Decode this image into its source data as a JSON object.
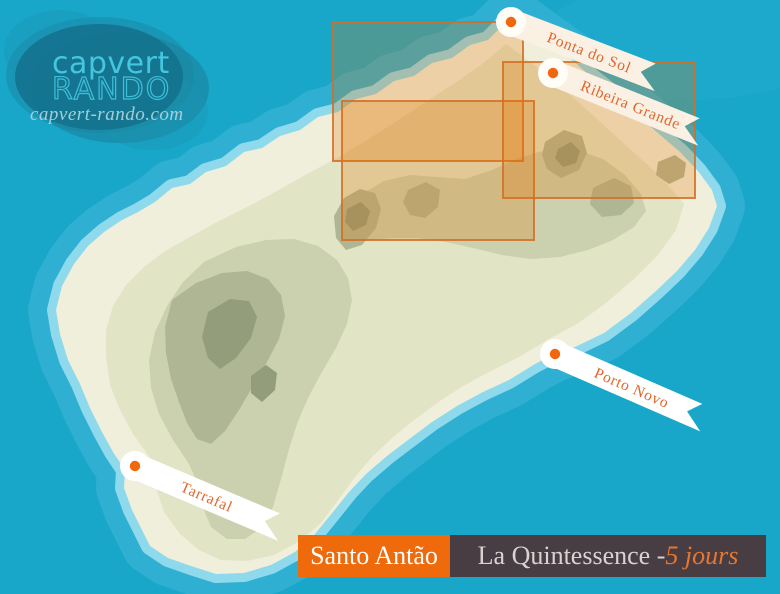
{
  "window": {
    "width": 780,
    "height": 594
  },
  "logo": {
    "brand_line1": "capvert",
    "brand_line2": "RANDO",
    "website": "capvert-rando.com"
  },
  "map": {
    "island_name": "Santo Antão",
    "markers": [
      {
        "label": "Ponta do Sol"
      },
      {
        "label": "Ribeira Grande"
      },
      {
        "label": "Porto Novo"
      },
      {
        "label": "Tarrafal"
      }
    ],
    "highlight_region_count": 3
  },
  "banner": {
    "island_label": "Santo Antão",
    "tour_title": "La Quintessence - ",
    "tour_duration": "5 jours"
  },
  "colors": {
    "ocean": "#18A7C9",
    "shallow_water_outer": "#2FAFD2",
    "shallow_water_inner": "#8ED9EB",
    "beach": "#F0EFDB",
    "accent_orange": "#EE6A0B",
    "banner_dark": "#493D44",
    "marker_dot": "#F2670D",
    "ribbon_text": "#DF662B",
    "ribbon_cream": "#FAF0E3",
    "logo_cyan": "#41C4DE"
  }
}
